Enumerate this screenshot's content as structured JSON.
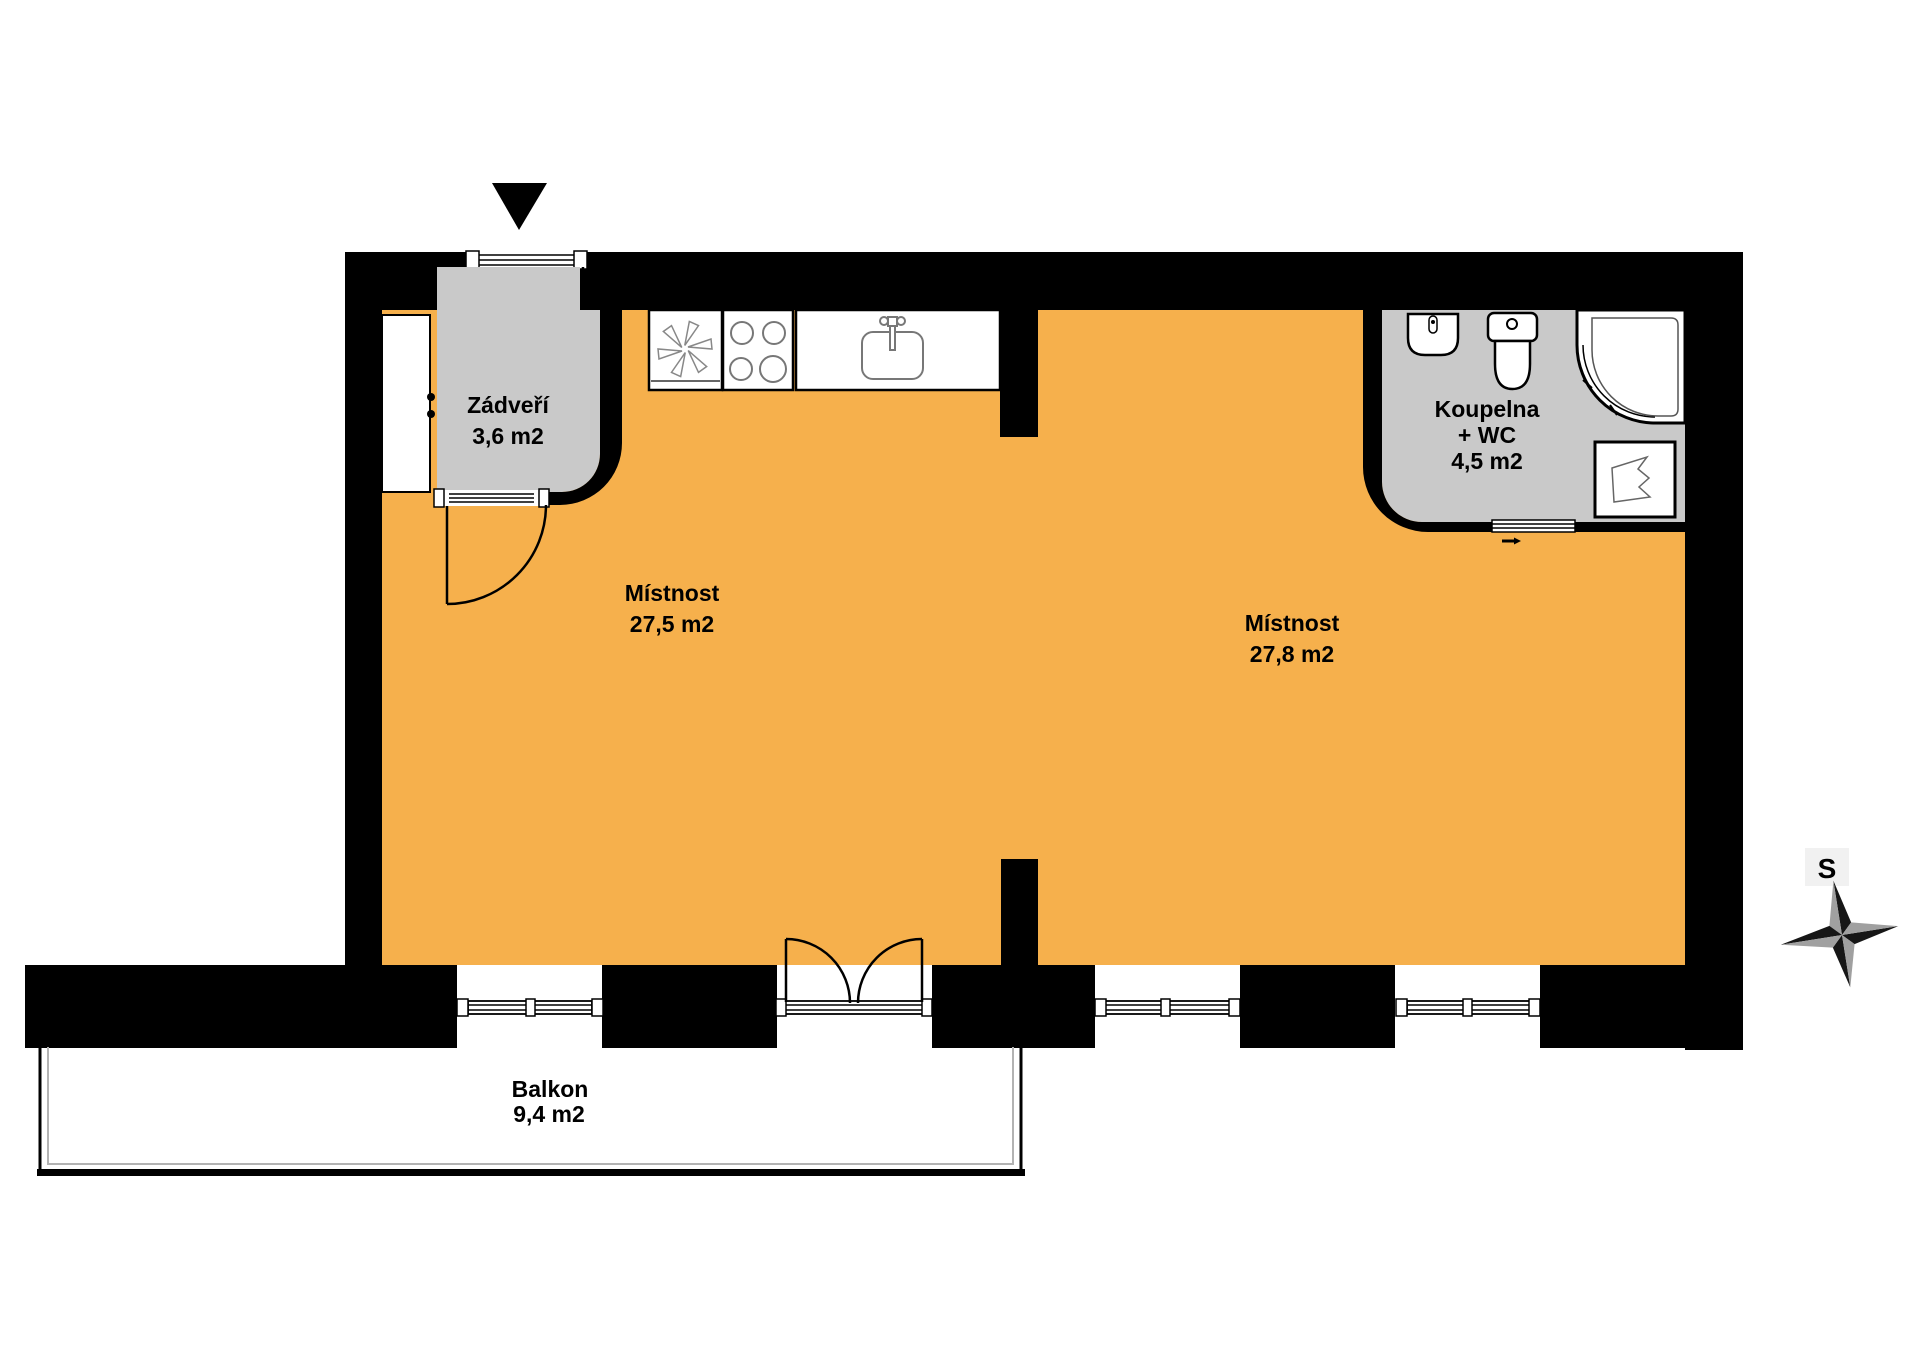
{
  "page": {
    "background": "#FFFFFF"
  },
  "colors": {
    "floor_main": "#F6B04C",
    "floor_secondary": "#C9C9C9",
    "wall": "#000000",
    "fixture_outline": "#777777",
    "railing_gray": "#B3B3B3",
    "compass_dark": "#161616",
    "compass_light": "#A0A0A0",
    "label_bg": "#F1F1F1"
  },
  "rooms": {
    "vestibule": {
      "name": "Zádveří",
      "area": "3,6 m2"
    },
    "room_left": {
      "name": "Místnost",
      "area": "27,5 m2"
    },
    "room_right": {
      "name": "Místnost",
      "area": "27,8 m2"
    },
    "bathroom": {
      "name": "Koupelna",
      "name_suffix": "+ WC",
      "area": "4,5 m2"
    },
    "balcony": {
      "name": "Balkon",
      "area": "9,4 m2"
    }
  },
  "compass": {
    "north_label": "S"
  }
}
